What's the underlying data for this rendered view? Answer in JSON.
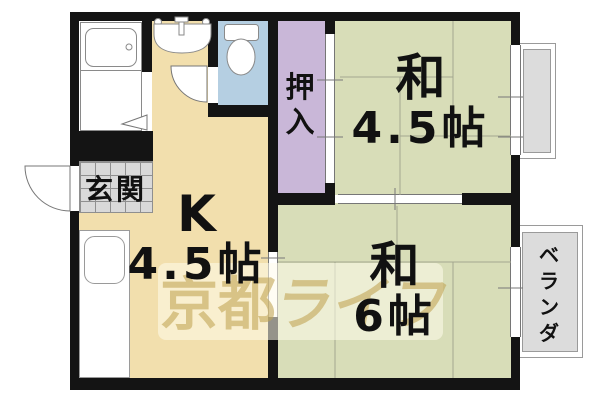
{
  "floorplan": {
    "entrance": {
      "label": "玄関"
    },
    "kitchen": {
      "letter": "K",
      "size": "4.5帖"
    },
    "closet": {
      "label": "押入"
    },
    "room_45": {
      "name": "和",
      "size": "4.5帖"
    },
    "room_6": {
      "name": "和",
      "size": "6帖"
    },
    "balcony": {
      "label": "ベランダ"
    },
    "watermark": {
      "kanji": "京都",
      "kana": "ライフ"
    },
    "fixtures": {
      "bathtub": "bathtub-icon",
      "washbasin": "washbasin-icon",
      "toilet": "toilet-icon",
      "kitchen_sink": "kitchen-sink-icon"
    },
    "colors": {
      "wall": "#141414",
      "kitchen_floor": "#f2dfad",
      "tatami_floor": "#d8ddb8",
      "closet_floor": "#c9b7d8",
      "toilet_floor": "#b5cfe2",
      "entrance_tile": "#d9d9d9",
      "balcony_fill": "#dcdcdc",
      "watermark_text": "#c1a555"
    }
  }
}
